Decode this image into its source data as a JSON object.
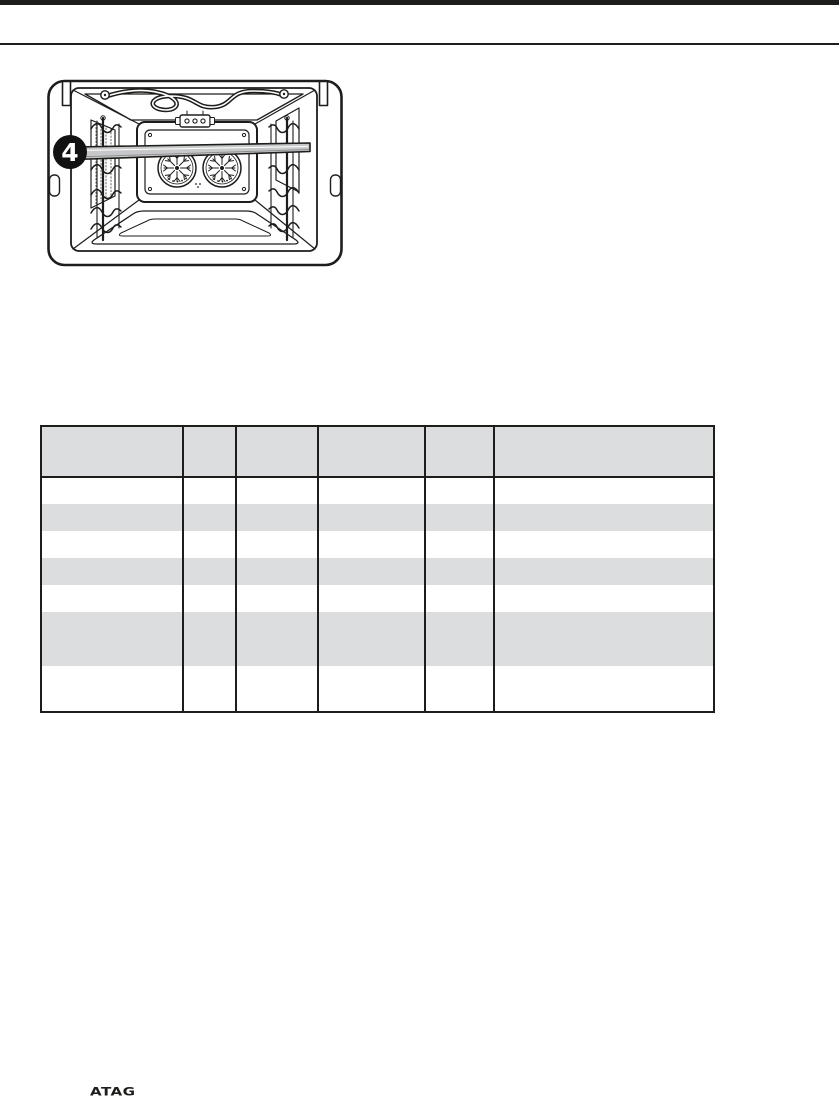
{
  "illustration": {
    "caption": "oven interior with shelf inserted at level 4",
    "badge_number": "4"
  },
  "table": {
    "header_height": 51,
    "columns": [
      {
        "label": "",
        "width": 142
      },
      {
        "label": "",
        "width": 53
      },
      {
        "label": "",
        "width": 82
      },
      {
        "label": "",
        "width": 107
      },
      {
        "label": "",
        "width": 69
      },
      {
        "label": "",
        "width": 220
      }
    ],
    "rows": [
      {
        "cells": [
          "",
          "",
          "",
          "",
          "",
          ""
        ],
        "height": 27,
        "shaded": false
      },
      {
        "cells": [
          "",
          "",
          "",
          "",
          "",
          ""
        ],
        "height": 27,
        "shaded": true
      },
      {
        "cells": [
          "",
          "",
          "",
          "",
          "",
          ""
        ],
        "height": 27,
        "shaded": false
      },
      {
        "cells": [
          "",
          "",
          "",
          "",
          "",
          ""
        ],
        "height": 27,
        "shaded": true
      },
      {
        "cells": [
          "",
          "",
          "",
          "",
          "",
          ""
        ],
        "height": 27,
        "shaded": false
      },
      {
        "cells": [
          "",
          "",
          "",
          "",
          "",
          ""
        ],
        "height": 54,
        "shaded": true
      },
      {
        "cells": [
          "",
          "",
          "",
          "",
          "",
          ""
        ],
        "height": 46,
        "shaded": false
      }
    ]
  },
  "footer": {
    "brand": "ATAG"
  },
  "colors": {
    "line": "#1d1d1b",
    "table_shade": "#dcddde",
    "shelf_fill": "#c7c8c9",
    "badge_fill": "#121212"
  }
}
